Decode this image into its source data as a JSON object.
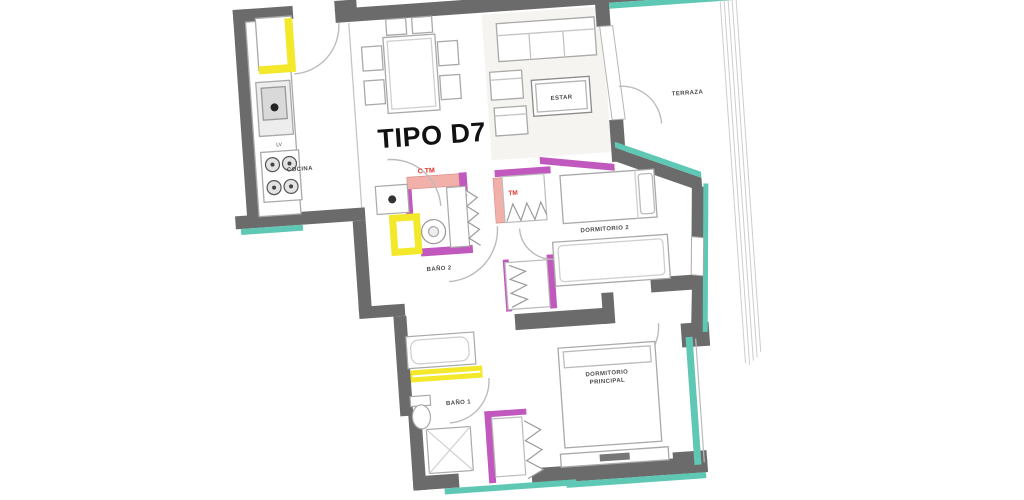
{
  "plan": {
    "title": "TIPO D7",
    "rooms": {
      "cocina": "COCINA",
      "estar": "ESTAR",
      "terraza": "TERRAZA",
      "dormitorio2": "DORMITORIO 2",
      "dormitorio_principal_line1": "DORMITORIO",
      "dormitorio_principal_line2": "PRINCIPAL",
      "bano1": "BAÑO 1",
      "bano2": "BAÑO 2"
    },
    "appliances": {
      "dishwasher": "LV"
    },
    "annotations": {
      "heater_note": "C  TM",
      "closet_note": "TM"
    },
    "colors": {
      "wall": "#6b6b6b",
      "partition": "#c158bd",
      "glazing": "#5fc8b5",
      "highlight": "#f3e829",
      "accent_red": "#e03028",
      "salmon": "#f2b0aa",
      "furniture_line": "#a9a9a9",
      "label": "#4a4a4a",
      "title": "#111111"
    }
  }
}
